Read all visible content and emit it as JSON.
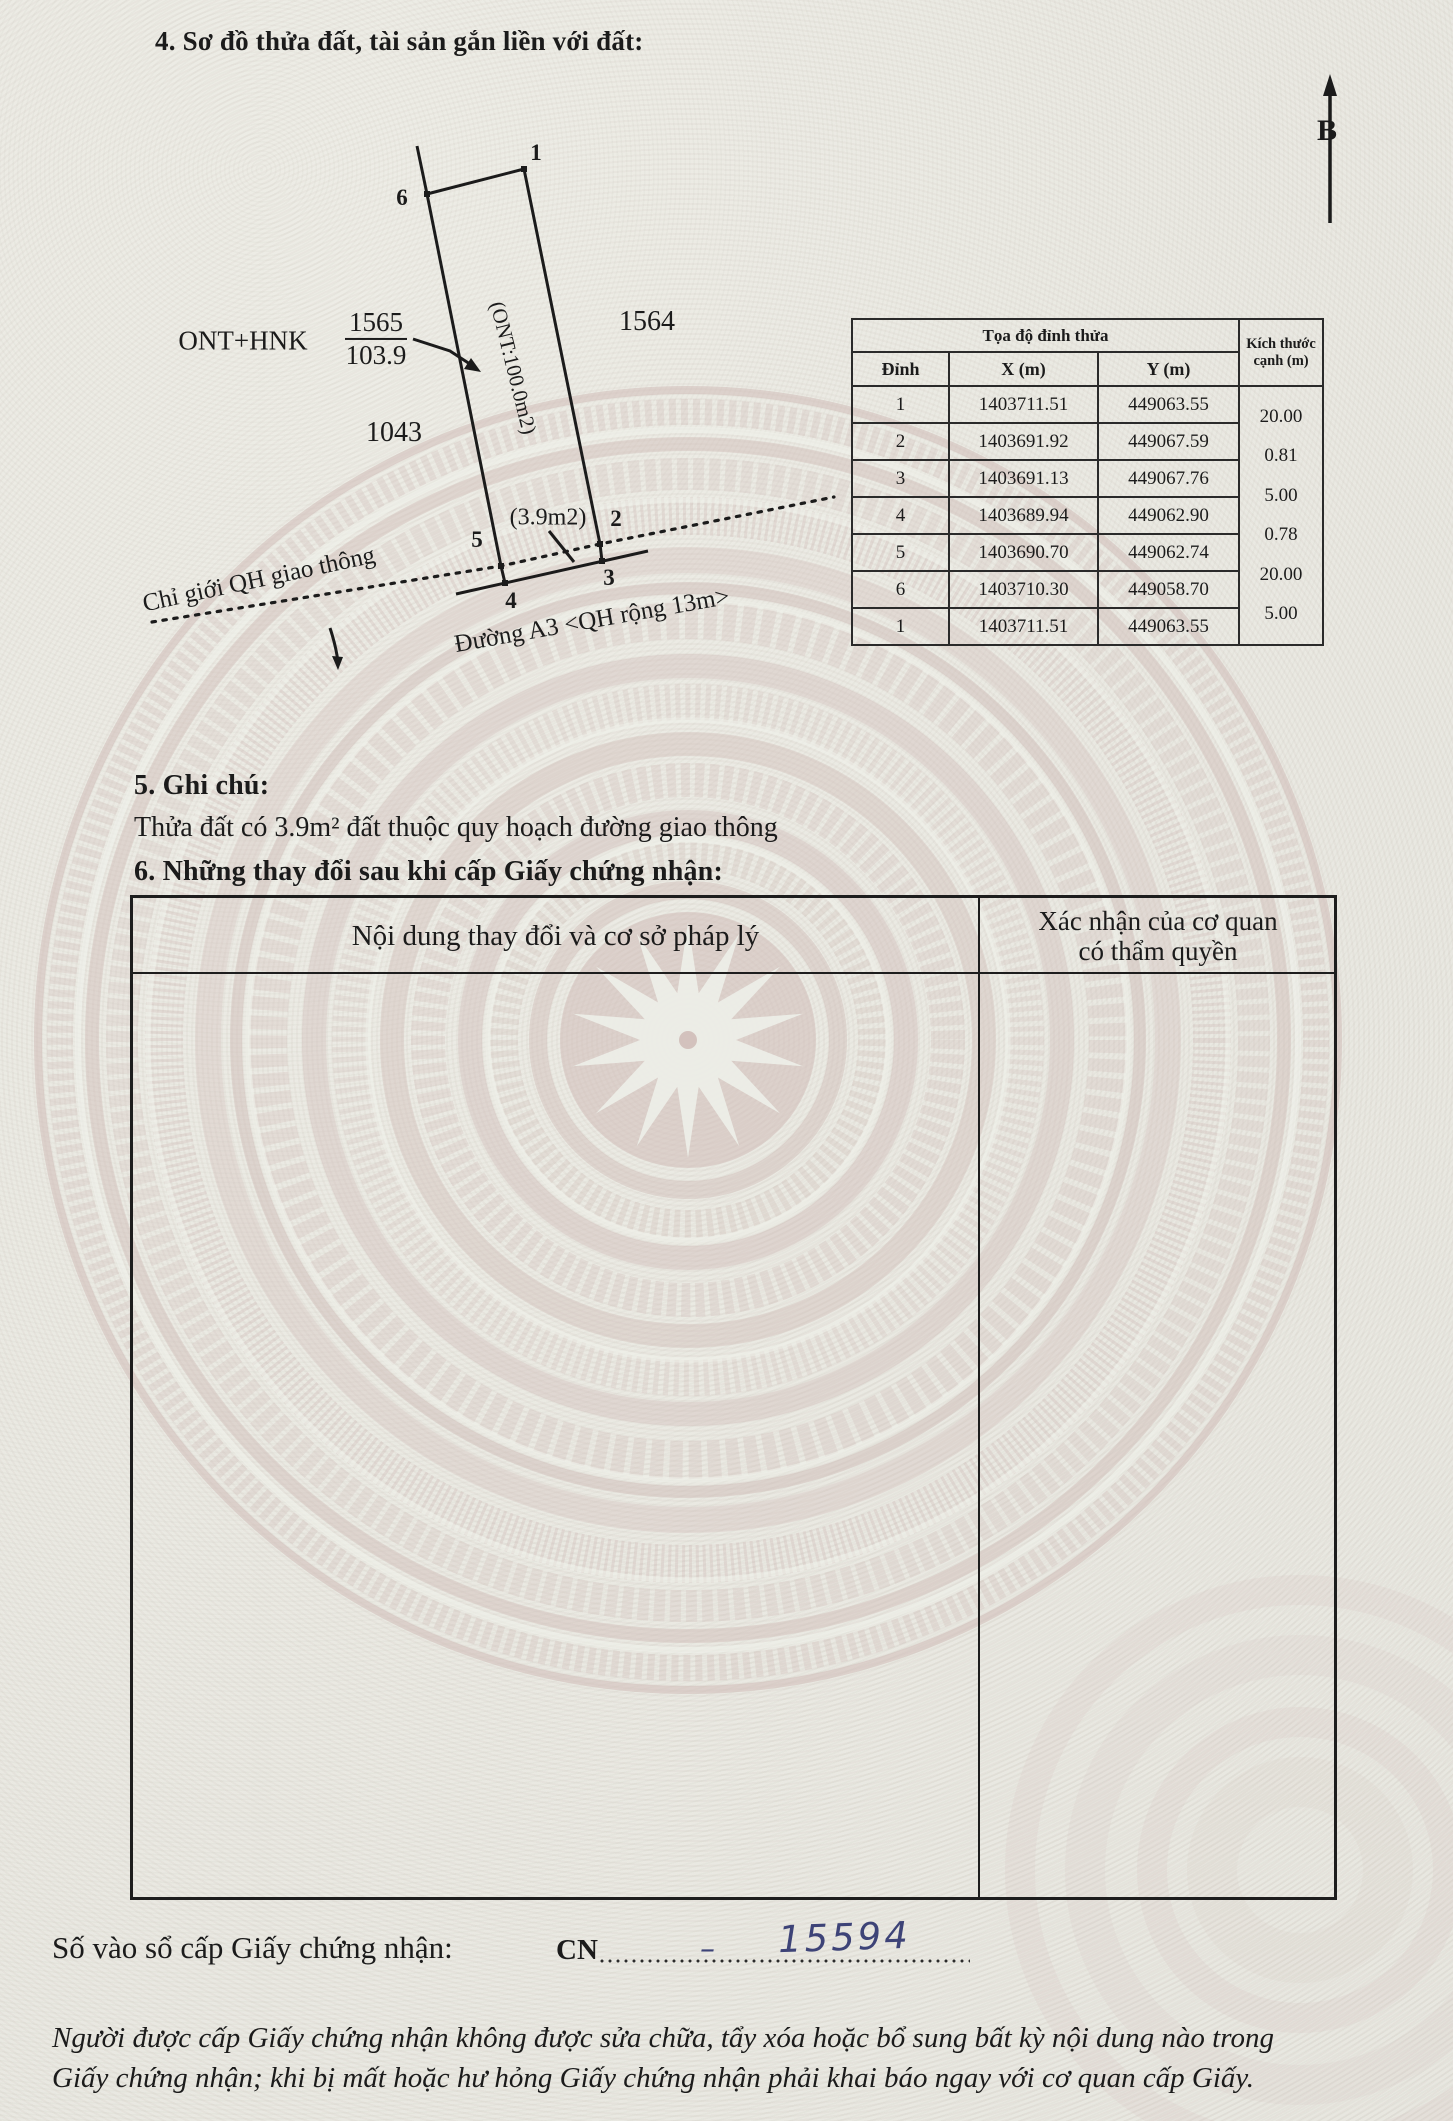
{
  "header": {
    "section4_title": "4. Sơ đồ thửa đất, tài sản gắn liền với đất:",
    "north_label": "B"
  },
  "diagram": {
    "vertex_labels": {
      "v1": "1",
      "v2": "2",
      "v3": "3",
      "v4": "4",
      "v5": "5",
      "v6": "6"
    },
    "left_use_code": "ONT+HNK",
    "parcel_number": "1565",
    "parcel_area": "103.9",
    "neighbor_parcel_left": "1043",
    "neighbor_parcel_right": "1564",
    "inner_area_label": "(ONT:100.0m2)",
    "strip_area_label": "(3.9m2)",
    "planning_boundary_label": "Chỉ giới QH giao thông",
    "road_label": "Đường A3 <QH rộng 13m>"
  },
  "coord_table": {
    "title": "Tọa độ đỉnh thửa",
    "col_vertex": "Đỉnh",
    "col_x": "X (m)",
    "col_y": "Y (m)",
    "col_edge_line1": "Kích thước",
    "col_edge_line2": "cạnh (m)",
    "rows": [
      [
        "1",
        "1403711.51",
        "449063.55"
      ],
      [
        "2",
        "1403691.92",
        "449067.59"
      ],
      [
        "3",
        "1403691.13",
        "449067.76"
      ],
      [
        "4",
        "1403689.94",
        "449062.90"
      ],
      [
        "5",
        "1403690.70",
        "449062.74"
      ],
      [
        "6",
        "1403710.30",
        "449058.70"
      ],
      [
        "1",
        "1403711.51",
        "449063.55"
      ]
    ],
    "edges": [
      "20.00",
      "0.81",
      "5.00",
      "0.78",
      "20.00",
      "5.00"
    ]
  },
  "section5": {
    "title": "5. Ghi chú:",
    "note": "Thửa đất có 3.9m² đất thuộc quy hoạch đường giao thông"
  },
  "section6": {
    "title": "6. Những thay đổi sau khi cấp Giấy chứng nhận:",
    "col_left": "Nội dung thay đổi và cơ sở pháp lý",
    "col_right_line1": "Xác nhận của cơ quan",
    "col_right_line2": "có thẩm quyền"
  },
  "footer": {
    "serial_label": "Số vào sổ cấp Giấy chứng nhận:",
    "serial_prefix": "CN",
    "serial_dash": "–",
    "serial_number": "15594",
    "notice_line1": "Người được cấp Giấy chứng nhận không được sửa chữa, tẩy xóa hoặc bổ sung bất kỳ nội dung nào trong",
    "notice_line2": "Giấy chứng nhận; khi bị mất hoặc hư hỏng Giấy chứng nhận phải khai báo ngay với cơ quan cấp Giấy."
  },
  "colors": {
    "ink_blue": "#3d4377",
    "pattern_pink": "#cdb7b3",
    "text": "#1b1b1b"
  }
}
